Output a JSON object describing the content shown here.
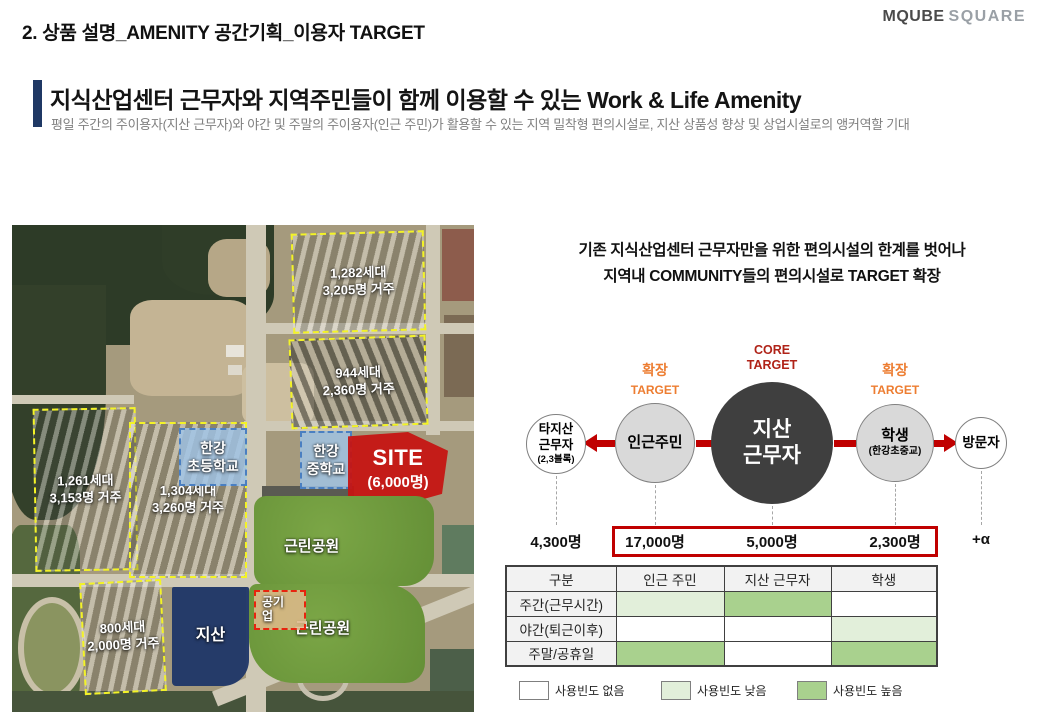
{
  "page": {
    "title": "2. 상품 설명_AMENITY 공간기획_이용자 TARGET"
  },
  "logo": {
    "primary": "MQUBE",
    "secondary": "SQUARE"
  },
  "headline": {
    "title": "지식산업센터 근무자와 지역주민들이 함께 이용할 수 있는 Work & Life Amenity",
    "subtitle": "평일 주간의 주이용자(지산 근무자)와 야간 및 주말의 주이용자(인근 주민)가 활용할 수 있는 지역 밀착형 편의시설로, 지산 상품성 향상 및 상업시설로의 앵커역할 기대"
  },
  "map": {
    "blocks": [
      {
        "line1": "1,282세대",
        "line2": "3,205명 거주"
      },
      {
        "line1": "944세대",
        "line2": "2,360명 거주"
      },
      {
        "line1": "1,261세대",
        "line2": "3,153명 거주"
      },
      {
        "line1": "1,304세대",
        "line2": "3,260명 거주"
      },
      {
        "line1": "800세대",
        "line2": "2,000명 거주"
      }
    ],
    "schools": [
      {
        "line1": "한강",
        "line2": "초등학교"
      },
      {
        "line1": "한강",
        "line2": "중학교"
      }
    ],
    "site": {
      "label": "SITE",
      "capacity": "(6,000명)"
    },
    "jisan_pads": [
      {
        "line1": "지",
        "line2": "산"
      },
      {
        "line1": "지산"
      }
    ],
    "jisan_built": "지산",
    "public_enterprise": {
      "line1": "공기",
      "line2": "업"
    },
    "parks": [
      "근린공원",
      "근린공원"
    ]
  },
  "panel": {
    "intro_line1": "기존 지식산업센터 근무자만을 위한 편의시설의 한계를 벗어나",
    "intro_line2": "지역내 COMMUNITY들의 편의시설로 TARGET 확장",
    "core_target": {
      "line1": "CORE",
      "line2": "TARGET"
    },
    "expand_left": {
      "line1": "확장",
      "line2": "TARGET"
    },
    "expand_right": {
      "line1": "확장",
      "line2": "TARGET"
    },
    "circles": {
      "other_jisan": {
        "line1": "타지산",
        "line2": "근무자",
        "line3": "(2,3블록)",
        "count": "4,300명"
      },
      "neighbors": {
        "label": "인근주민",
        "count": "17,000명"
      },
      "core": {
        "line1": "지산",
        "line2": "근무자",
        "count": "5,000명"
      },
      "students": {
        "label": "학생",
        "sub": "(한강초중교)",
        "count": "2,300명"
      },
      "visitors": {
        "label": "방문자",
        "count": "+α"
      }
    }
  },
  "table": {
    "columns": [
      "구분",
      "인근 주민",
      "지산 근무자",
      "학생"
    ],
    "rows": [
      {
        "label": "주간(근무시간)",
        "cells": [
          "low",
          "high",
          "none"
        ]
      },
      {
        "label": "야간(퇴근이후)",
        "cells": [
          "none",
          "none",
          "low"
        ]
      },
      {
        "label": "주말/공휴일",
        "cells": [
          "high",
          "none",
          "high"
        ]
      }
    ],
    "colors": {
      "none": "#FFFFFF",
      "low": "#E2EFDA",
      "high": "#A9D18E"
    },
    "legend": [
      {
        "level": "none",
        "label": "사용빈도 없음"
      },
      {
        "level": "low",
        "label": "사용빈도 낮음"
      },
      {
        "level": "high",
        "label": "사용빈도 높음"
      }
    ]
  },
  "colors": {
    "accent_navy": "#1F3864",
    "core_red": "#C00000",
    "expand_orange": "#ED7D31",
    "site_red": "#C51412",
    "low_green": "#E2EFDA",
    "high_green": "#A9D18E",
    "yellow_dash": "#F3F327"
  }
}
